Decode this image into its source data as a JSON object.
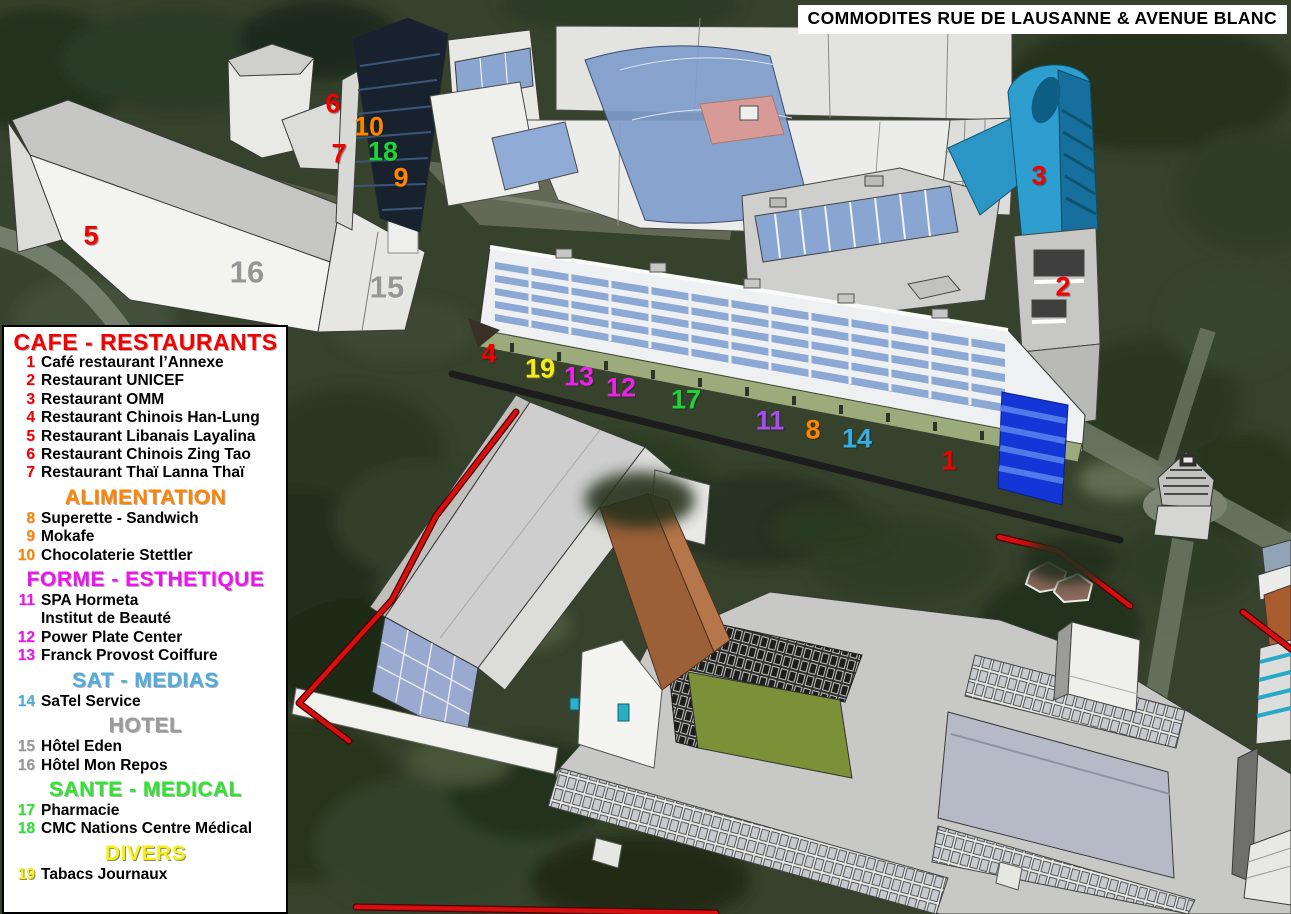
{
  "title": "COMMODITES RUE DE LAUSANNE & AVENUE BLANC",
  "colors": {
    "cafe": "#F50000",
    "alimentation": "#FF8400",
    "forme": "#F011F0",
    "forme_violet": "#A94DF2",
    "sat": "#35B0E6",
    "hotel": "#969696",
    "sante": "#1FD435",
    "divers": "#F4EB18",
    "tower_blue": "#2E9ECF",
    "red_path": "#D60F0F",
    "black_road": "#1D1D1D",
    "green_shopfront": "#9CAB7C",
    "courtyard_green": "#7C9037"
  },
  "legend": {
    "sections": [
      {
        "id": "cafe",
        "title": "CAFE - RESTAURANTS",
        "items": [
          {
            "num": "1",
            "label": "Café restaurant l’Annexe"
          },
          {
            "num": "2",
            "label": "Restaurant UNICEF"
          },
          {
            "num": "3",
            "label": "Restaurant OMM"
          },
          {
            "num": "4",
            "label": "Restaurant Chinois Han-Lung"
          },
          {
            "num": "5",
            "label": "Restaurant Libanais Layalina"
          },
          {
            "num": "6",
            "label": "Restaurant Chinois Zing Tao"
          },
          {
            "num": "7",
            "label": "Restaurant Thaï Lanna Thaï"
          }
        ]
      },
      {
        "id": "alimentation",
        "title": "ALIMENTATION",
        "items": [
          {
            "num": "8",
            "label": "Superette - Sandwich"
          },
          {
            "num": "9",
            "label": "Mokafe"
          },
          {
            "num": "10",
            "label": "Chocolaterie Stettler"
          }
        ]
      },
      {
        "id": "forme",
        "title": "FORME - ESTHETIQUE",
        "items": [
          {
            "num": "11",
            "label": "SPA Hormeta"
          },
          {
            "num": "",
            "label": "Institut de Beauté"
          },
          {
            "num": "12",
            "label": "Power Plate Center"
          },
          {
            "num": "13",
            "label": "Franck Provost Coiffure"
          }
        ]
      },
      {
        "id": "sat",
        "title": "SAT - MEDIAS",
        "items": [
          {
            "num": "14",
            "label": "SaTel Service"
          }
        ]
      },
      {
        "id": "hotel",
        "title": "HOTEL",
        "items": [
          {
            "num": "15",
            "label": "Hôtel Eden"
          },
          {
            "num": "16",
            "label": "Hôtel Mon Repos"
          }
        ]
      },
      {
        "id": "sante",
        "title": "SANTE - MEDICAL",
        "items": [
          {
            "num": "17",
            "label": "Pharmacie"
          },
          {
            "num": "18",
            "label": "CMC Nations Centre Médical"
          }
        ]
      },
      {
        "id": "divers",
        "title": "DIVERS",
        "items": [
          {
            "num": "19",
            "label": "Tabacs Journaux"
          }
        ]
      }
    ]
  },
  "markers": [
    {
      "num": "1",
      "category": "cafe",
      "x": 949,
      "y": 461
    },
    {
      "num": "2",
      "category": "cafe",
      "x": 1063,
      "y": 287
    },
    {
      "num": "3",
      "category": "cafe",
      "x": 1039,
      "y": 176
    },
    {
      "num": "4",
      "category": "cafe",
      "x": 489,
      "y": 354
    },
    {
      "num": "5",
      "category": "cafe",
      "x": 91,
      "y": 236
    },
    {
      "num": "6",
      "category": "cafe",
      "x": 333,
      "y": 104
    },
    {
      "num": "7",
      "category": "cafe",
      "x": 339,
      "y": 154
    },
    {
      "num": "8",
      "category": "alimentation",
      "x": 813,
      "y": 430
    },
    {
      "num": "9",
      "category": "alimentation",
      "x": 401,
      "y": 178
    },
    {
      "num": "10",
      "category": "alimentation",
      "x": 369,
      "y": 127
    },
    {
      "num": "11",
      "category": "forme-violet",
      "x": 770,
      "y": 421
    },
    {
      "num": "12",
      "category": "forme",
      "x": 621,
      "y": 388
    },
    {
      "num": "13",
      "category": "forme",
      "x": 579,
      "y": 377
    },
    {
      "num": "14",
      "category": "sat",
      "x": 857,
      "y": 439
    },
    {
      "num": "15",
      "category": "hotel",
      "x": 387,
      "y": 287
    },
    {
      "num": "16",
      "category": "hotel",
      "x": 247,
      "y": 272
    },
    {
      "num": "17",
      "category": "sante",
      "x": 686,
      "y": 400
    },
    {
      "num": "18",
      "category": "sante",
      "x": 383,
      "y": 152
    },
    {
      "num": "19",
      "category": "divers",
      "x": 540,
      "y": 369
    }
  ]
}
